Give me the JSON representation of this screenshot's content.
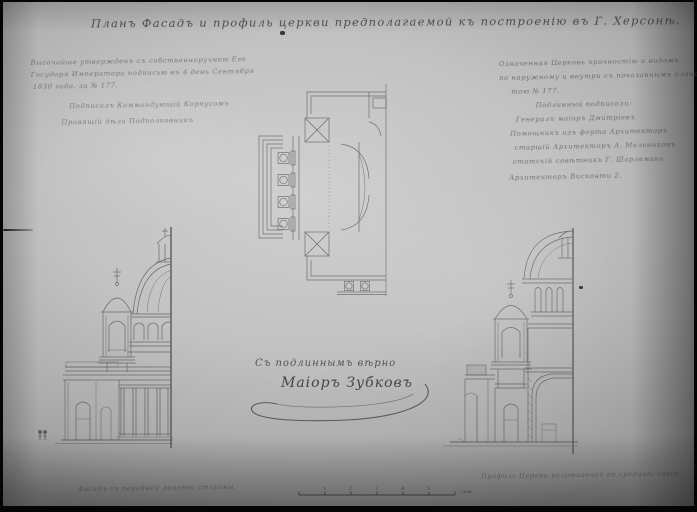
{
  "photo": {
    "paper_light": "#d0d0d0",
    "paper_dark": "#949494",
    "ink": "#3a3e44",
    "frame": "#050505"
  },
  "title": {
    "text": "Планъ Фасадъ и профиль церкви предполагаемой къ построенію въ Г. Херсонѣ."
  },
  "left_annotation": {
    "lines": [
      "Высочайше утвержденъ съ собственноручною Его",
      "Государя Императора подписью въ 4 день Сентября",
      "1830 года. за № 177.",
      "Подписалъ Коммандующій Корпусомъ",
      "Правящій дѣла Подполковникъ"
    ]
  },
  "right_annotation": {
    "lines": [
      "Означенная Церковь прочностію и видомъ",
      "по наружному и внутри съ показаннымъ планомъ",
      "тою № 177.",
      "Подлинный подписали:",
      "Генералъ маіоръ Дмитріевъ",
      "Помощникъ изъ форта Архитекторъ",
      "старшій Архитекторъ А. Мельниковъ",
      "статскій совѣтникъ Г. Шарлемань",
      "Архитекторъ Висконти 2."
    ]
  },
  "certification": {
    "line": "Съ подлиннымъ вѣрно",
    "signature": "Маіоръ Зубковъ"
  },
  "captions": {
    "bottom_left": "Фасадъ съ передней лицевой стороны",
    "bottom_right": "Профиль Церкви разрѣзанной по срединѣ линіи"
  },
  "scale_bar": {
    "numbers": [
      "1",
      "2",
      "3",
      "4",
      "5"
    ],
    "unit": "саж."
  },
  "drawings": {
    "plan": "church-floor-plan-half",
    "left_elevation": "facade-half-elevation-with-dome-and-belltower",
    "right_section": "section-half-profile-with-dome-and-belltower"
  }
}
